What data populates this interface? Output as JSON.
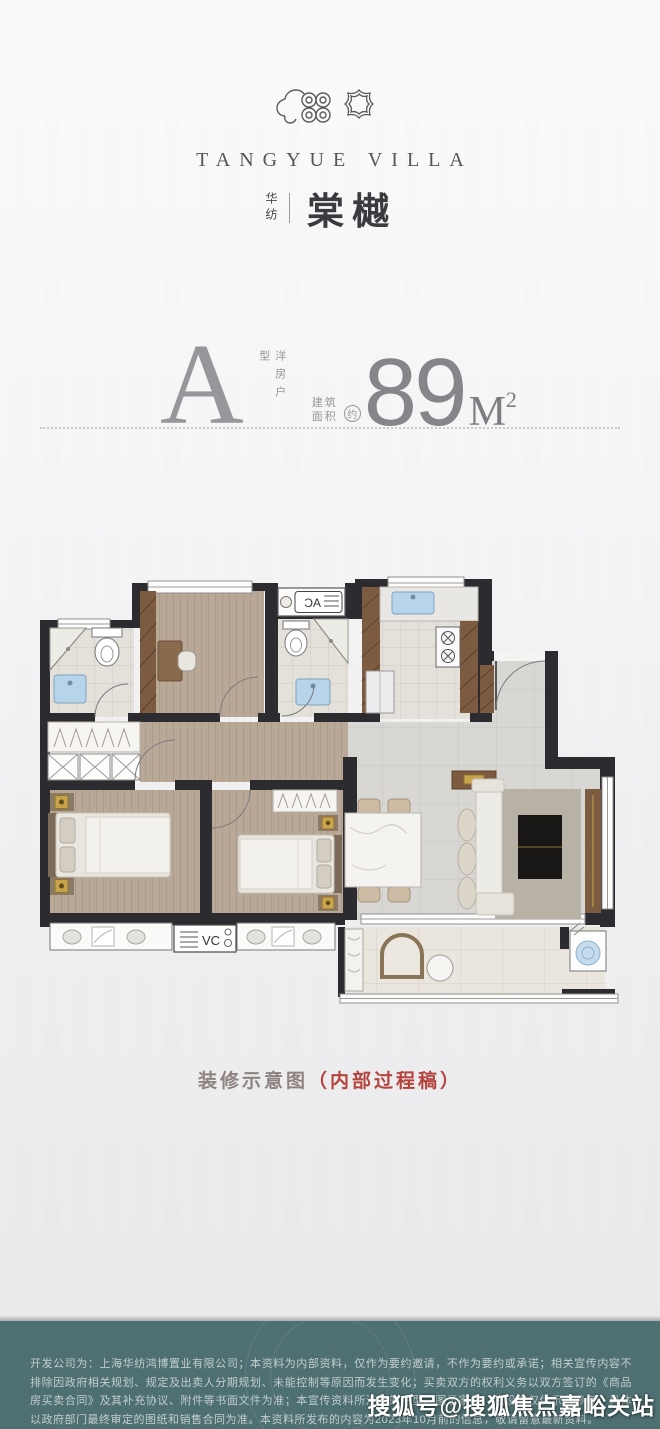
{
  "brand": {
    "logo_icon": "cloud-spiral-and-quatrefoil-emblem",
    "name_en": "TANGYUE VILLA",
    "name_cn_small": "华纺",
    "name_cn_large": "棠樾"
  },
  "unit": {
    "type_letter": "A",
    "type_desc_vertical": "洋房户型",
    "area_label_line1": "建筑",
    "area_label_line2": "面积",
    "approx_label": "约",
    "area_value": "89",
    "area_unit": "M",
    "area_unit_sup": "2"
  },
  "plan": {
    "ac_label": "AC",
    "vc_label": "VC",
    "colors": {
      "wall": "#2c2b30",
      "wood_floor": "#b9a898",
      "tile_floor": "#e3dfd9",
      "hall_tile": "#d8d6d2",
      "balcony_tile": "#e9e4dc",
      "cabinet_brown": "#7d5b40",
      "fixture_blue": "#b8d4ea",
      "lamp_gold": "#c8a34e"
    }
  },
  "caption": {
    "text_main": "装修示意图",
    "text_note": "（内部过程稿）",
    "main_color": "#8d8380",
    "note_color": "#b5433e"
  },
  "footer": {
    "bg_color": "#4e7072",
    "disclaimer": "开发公司为：上海华纺鸿博置业有限公司；本资料为内部资料，仅作为要约邀请，不作为要约或承诺；相关宣传内容不排除因政府相关规划、规定及出卖人分期规划、未能控制等原因而发生变化；买卖双方的权利义务以双方签订的《商品房买卖合同》及其补充协议、附件等书面文件为准；本宣传资料所涉及的户型、图示家具、陈设等仅供示意参考，具体以政府部门最终审定的图纸和销售合同为准。本资料所发布的内容为2023年10月前的信息，敬请留意最新资料。"
  },
  "watermark": {
    "text": "搜狐号@搜狐焦点嘉峪关站"
  }
}
